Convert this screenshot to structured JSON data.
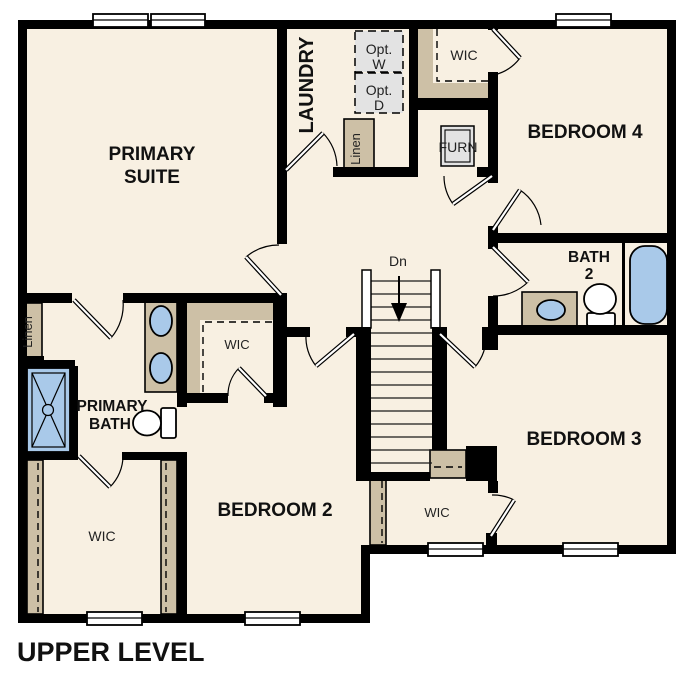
{
  "plan": {
    "title": "UPPER LEVEL",
    "labels": {
      "primary_suite_line1": "PRIMARY",
      "primary_suite_line2": "SUITE",
      "laundry": "LAUNDRY",
      "opt_w_line1": "Opt.",
      "opt_w_line2": "W",
      "opt_d_line1": "Opt.",
      "opt_d_line2": "D",
      "linen_top": "Linen",
      "wic_top": "WIC",
      "furn": "FURN",
      "bedroom4": "BEDROOM 4",
      "bath2_line1": "BATH",
      "bath2_line2": "2",
      "stairs_dn": "Dn",
      "wic_primary": "WIC",
      "primary_bath_line1": "PRIMARY",
      "primary_bath_line2": "BATH",
      "linen_left": "Linen",
      "wic_bottom_left": "WIC",
      "bedroom2": "BEDROOM 2",
      "wic_bedroom3": "WIC",
      "bedroom3": "BEDROOM 3"
    },
    "colors": {
      "floor": "#f8f0e2",
      "wall": "#000000",
      "closet": "#cdc0a6",
      "fixture_blue": "#a9c9e9",
      "appliance_gray": "#e3e3e3",
      "text": "#111111",
      "background": "#ffffff"
    }
  }
}
